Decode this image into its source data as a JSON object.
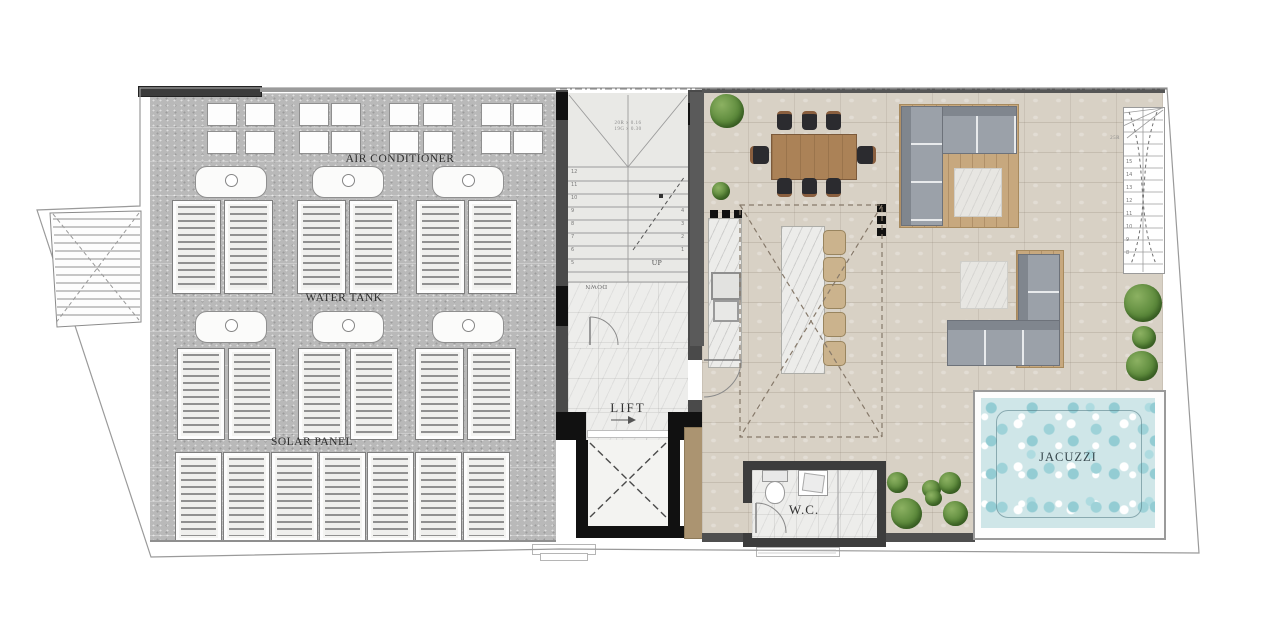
{
  "plan": {
    "title": "Roof level floor plan",
    "labels": {
      "air_conditioner": "AIR CONDITIONER",
      "water_tank": "WATER TANK",
      "solar_panel": "SOLAR PANEL",
      "lift": "LIFT",
      "wc": "W.C.",
      "jacuzzi": "JACUZZI",
      "up": "UP",
      "down": "DOWN"
    },
    "stairs": {
      "main_note_line1": "20R x 0.16",
      "main_note_line2": "19G x 0.30",
      "main_left_numbers": [
        "12",
        "11",
        "10",
        "9",
        "8",
        "7",
        "6",
        "5"
      ],
      "main_right_numbers": [
        "4",
        "3",
        "2",
        "1"
      ],
      "external_note": "25R",
      "external_numbers": [
        "15",
        "14",
        "13",
        "12",
        "11",
        "10",
        "9",
        "8"
      ]
    },
    "colors": {
      "roof_gray": "#b9b9b9",
      "terrace_floor": "#d8d1c5",
      "marble": "#ededeb",
      "wall_dark": "#4a4a4a",
      "wall_black": "#111111",
      "wood_table": "#ab8257",
      "deck_wood": "#c7a87e",
      "sofa_gray": "#9ba1a9",
      "stool_tan": "#cbb38d",
      "bush_green": "#5d8a3c",
      "water_blue": "#cfe6e8",
      "lift_strip_tan": "#ab9471"
    }
  }
}
